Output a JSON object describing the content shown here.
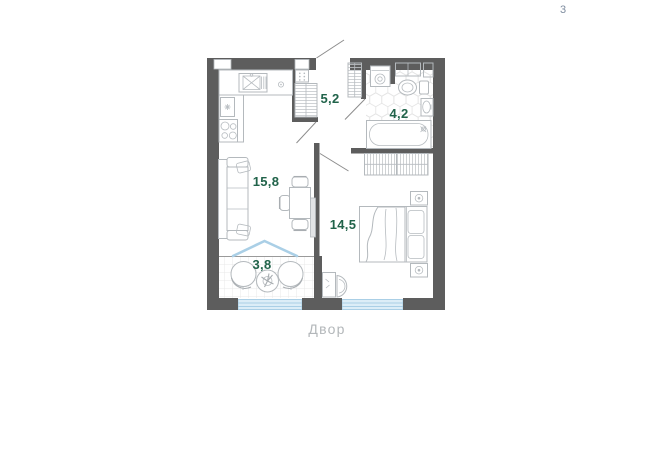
{
  "page": {
    "number": "3"
  },
  "floor_plan": {
    "courtyard_label": "Двор",
    "rooms": [
      {
        "name": "living-kitchen",
        "area_label": "15,8"
      },
      {
        "name": "hallway",
        "area_label": "5,2"
      },
      {
        "name": "bathroom",
        "area_label": "4,2"
      },
      {
        "name": "bedroom",
        "area_label": "14,5"
      },
      {
        "name": "balcony",
        "area_label": "3,8"
      }
    ],
    "colors": {
      "wall": "#5d5d5d",
      "room_label": "#21634a",
      "glazing_fill": "#dcedf7",
      "glazing_line": "#aacfe6",
      "courtyard_label": "#b3b7ba",
      "page_number": "#7e8c9f",
      "furniture_line": "#b4b9bd"
    }
  }
}
